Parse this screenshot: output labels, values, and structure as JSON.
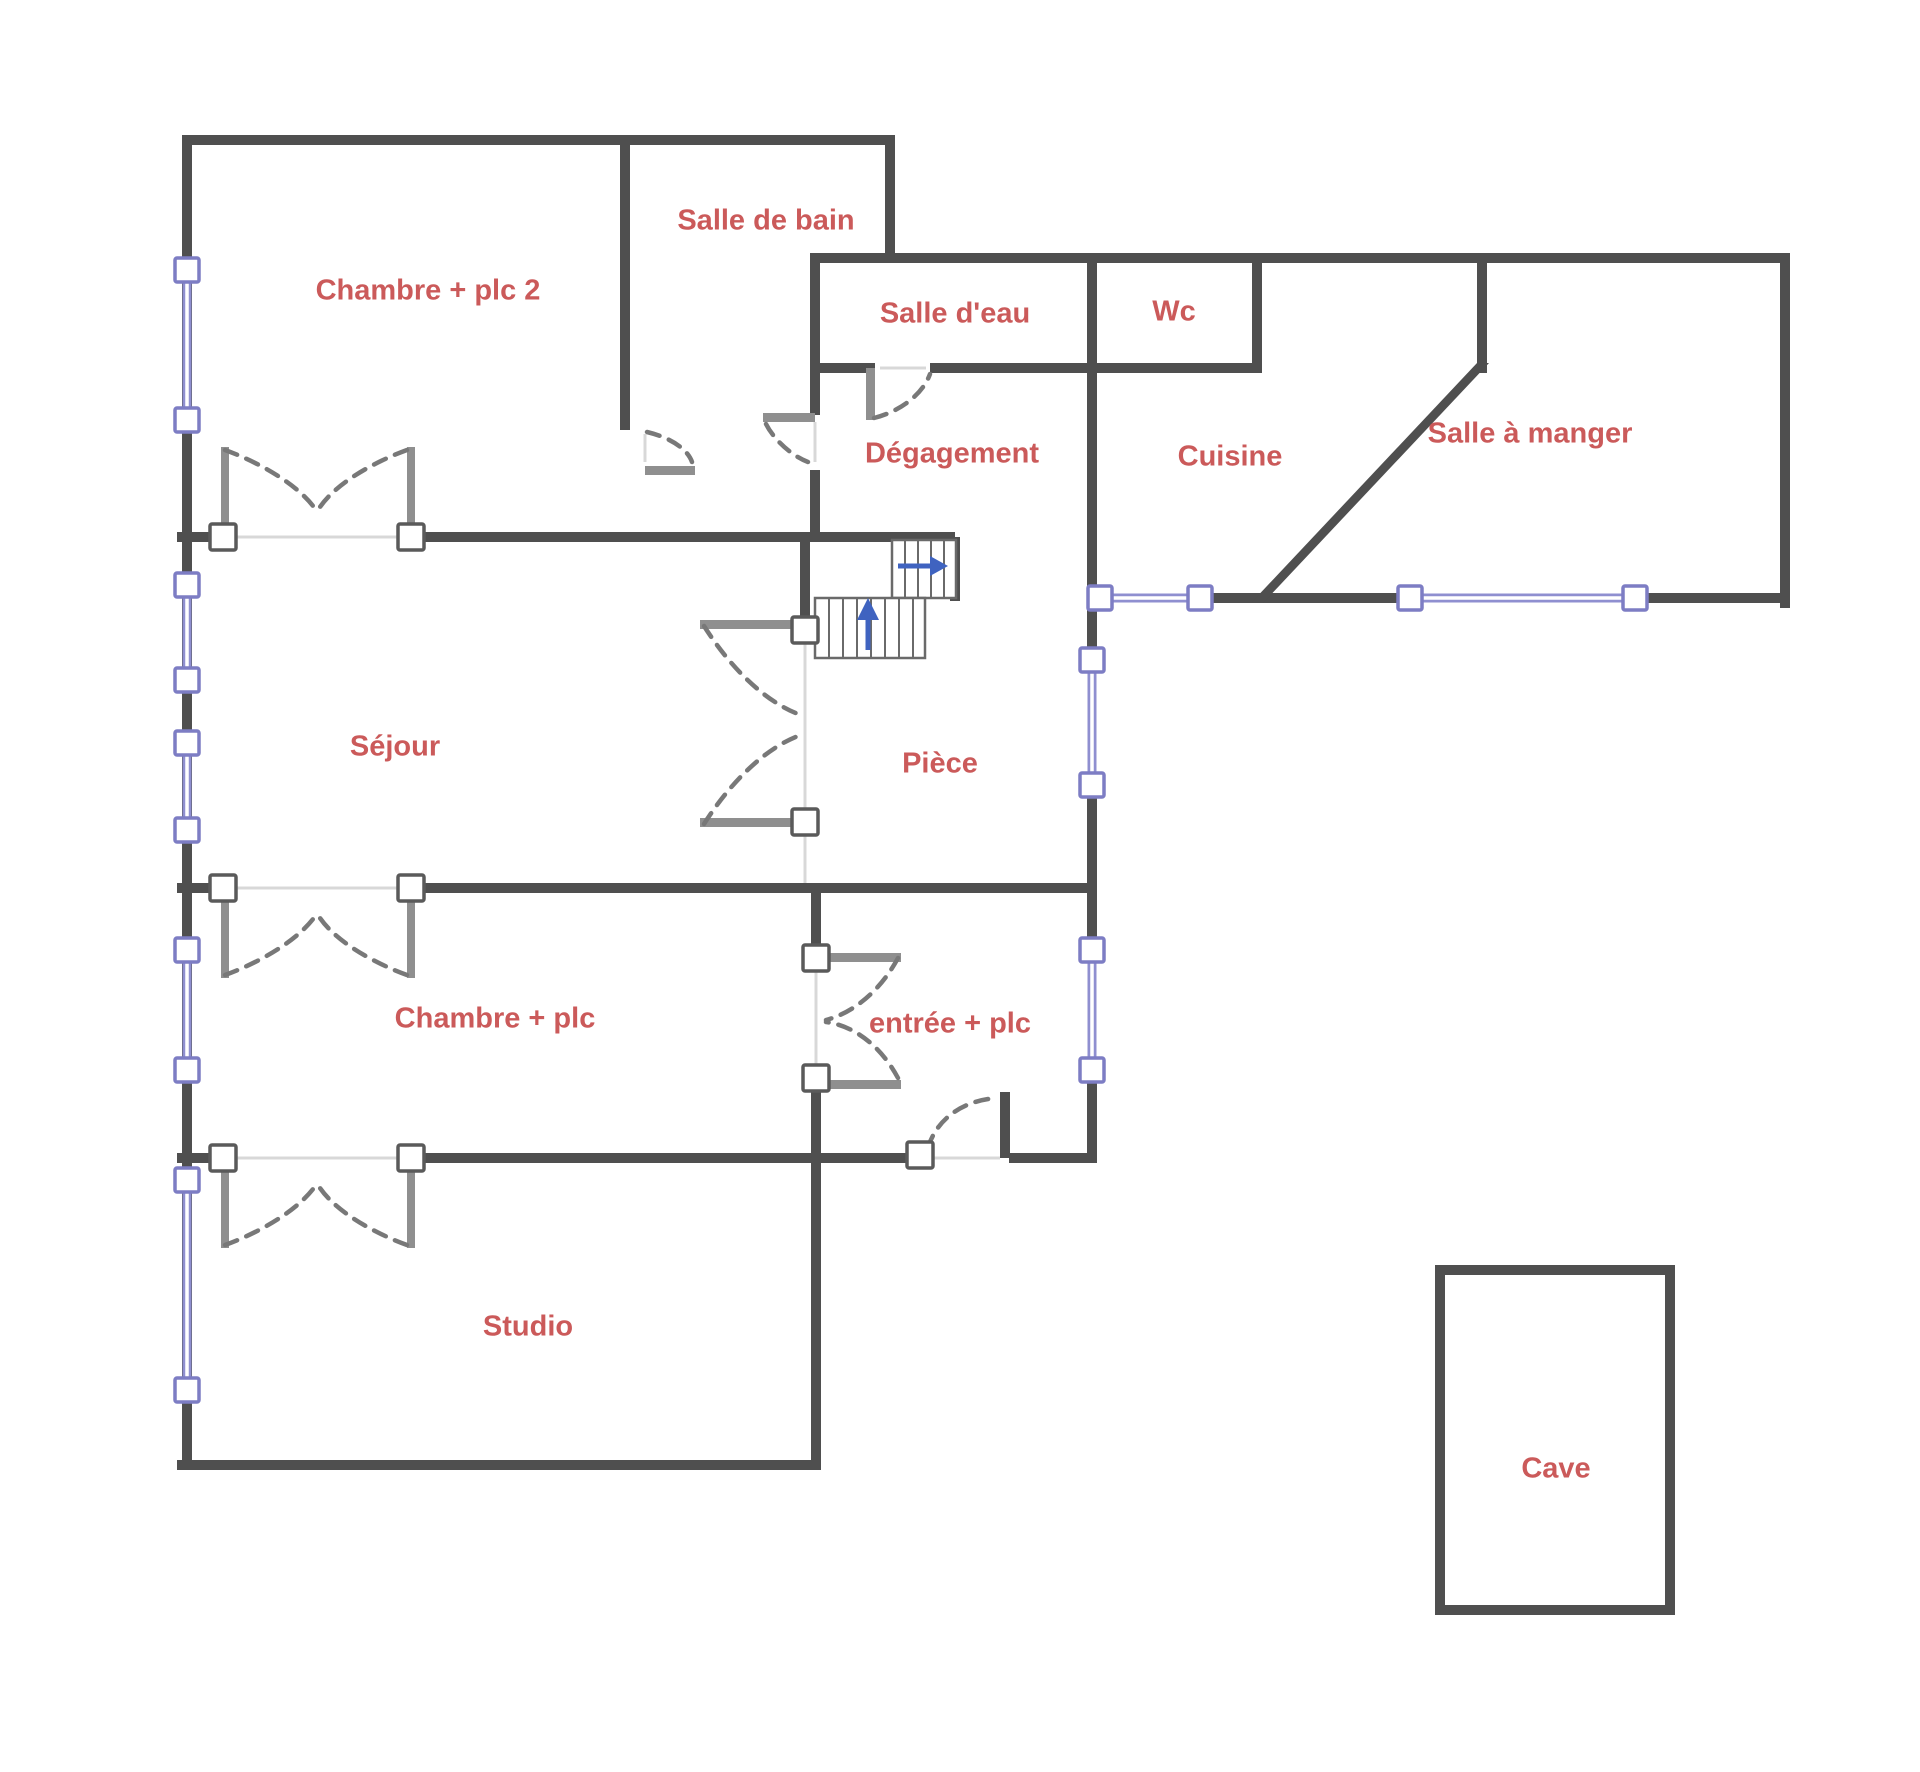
{
  "meta": {
    "canvas_width": 1920,
    "canvas_height": 1772,
    "type": "floor-plan"
  },
  "colors": {
    "background": "#ffffff",
    "wall": "#4f4f4f",
    "door_post": "#8f8f8f",
    "door_arc": "#787878",
    "thin_line": "#d8d8d8",
    "label": "#cb5a5a",
    "window_glass": "#8f8fd0",
    "window_border": "#7d7dc4",
    "handle_border": "#5a5a5a",
    "handle_fill": "#ffffff",
    "stair_outline": "#6a6a6a",
    "stair_arrow": "#3f63c0"
  },
  "rooms": [
    {
      "id": "chambre-plc-2",
      "label": "Chambre + plc 2",
      "x": 428,
      "y": 292
    },
    {
      "id": "salle-de-bain",
      "label": "Salle de bain",
      "x": 766,
      "y": 222
    },
    {
      "id": "salle-d-eau",
      "label": "Salle d'eau",
      "x": 955,
      "y": 315
    },
    {
      "id": "wc",
      "label": "Wc",
      "x": 1174,
      "y": 313
    },
    {
      "id": "degagement",
      "label": "Dégagement",
      "x": 952,
      "y": 455
    },
    {
      "id": "cuisine",
      "label": "Cuisine",
      "x": 1230,
      "y": 458
    },
    {
      "id": "salle-a-manger",
      "label": "Salle à manger",
      "x": 1530,
      "y": 435
    },
    {
      "id": "sejour",
      "label": "Séjour",
      "x": 395,
      "y": 748
    },
    {
      "id": "piece",
      "label": "Pièce",
      "x": 940,
      "y": 765
    },
    {
      "id": "chambre-plc",
      "label": "Chambre + plc",
      "x": 495,
      "y": 1020
    },
    {
      "id": "entree-plc",
      "label": "entrée + plc",
      "x": 950,
      "y": 1025
    },
    {
      "id": "studio",
      "label": "Studio",
      "x": 528,
      "y": 1328
    },
    {
      "id": "cave",
      "label": "Cave",
      "x": 1556,
      "y": 1470
    }
  ],
  "walls": {
    "rects": [
      [
        182,
        135,
        10,
        1335
      ],
      [
        182,
        135,
        713,
        10
      ],
      [
        885,
        135,
        10,
        128
      ],
      [
        810,
        253,
        980,
        10
      ],
      [
        1780,
        253,
        10,
        355
      ],
      [
        810,
        253,
        10,
        162
      ],
      [
        810,
        470,
        10,
        72
      ],
      [
        620,
        135,
        10,
        295
      ],
      [
        1087,
        253,
        10,
        407
      ],
      [
        1087,
        785,
        10,
        165
      ],
      [
        1087,
        1070,
        10,
        93
      ],
      [
        1252,
        253,
        10,
        120
      ],
      [
        1087,
        363,
        175,
        10
      ],
      [
        810,
        363,
        65,
        10
      ],
      [
        930,
        363,
        162,
        10
      ],
      [
        1477,
        253,
        10,
        120
      ],
      [
        177,
        532,
        48,
        10
      ],
      [
        415,
        532,
        540,
        10
      ],
      [
        950,
        537,
        10,
        64
      ],
      [
        800,
        532,
        10,
        93
      ],
      [
        1087,
        593,
        18,
        10
      ],
      [
        1195,
        593,
        220,
        10
      ],
      [
        1630,
        593,
        160,
        10
      ],
      [
        177,
        883,
        48,
        10
      ],
      [
        415,
        883,
        677,
        10
      ],
      [
        811,
        883,
        10,
        75
      ],
      [
        811,
        1080,
        10,
        78
      ],
      [
        177,
        1153,
        48,
        10
      ],
      [
        415,
        1153,
        510,
        10
      ],
      [
        1009,
        1153,
        83,
        10
      ],
      [
        1000,
        1092,
        10,
        66
      ],
      [
        811,
        1153,
        10,
        317
      ],
      [
        177,
        1460,
        644,
        10
      ],
      [
        1435,
        1265,
        240,
        10
      ],
      [
        1435,
        1265,
        10,
        350
      ],
      [
        1665,
        1265,
        10,
        350
      ],
      [
        1435,
        1605,
        240,
        10
      ]
    ],
    "polygons": [
      [
        [
          1477,
          363
        ],
        [
          1489,
          363
        ],
        [
          1263,
          603
        ],
        [
          1251,
          603
        ]
      ]
    ]
  },
  "door_posts": [
    [
      221,
      447,
      8,
      88
    ],
    [
      407,
      447,
      8,
      88
    ],
    [
      221,
      893,
      8,
      85
    ],
    [
      407,
      893,
      8,
      85
    ],
    [
      221,
      1163,
      8,
      85
    ],
    [
      407,
      1163,
      8,
      85
    ],
    [
      700,
      620,
      105,
      9
    ],
    [
      700,
      818,
      105,
      9
    ],
    [
      816,
      953,
      85,
      9
    ],
    [
      816,
      1080,
      85,
      9
    ],
    [
      645,
      466,
      50,
      9
    ],
    [
      763,
      413,
      52,
      9
    ],
    [
      866,
      368,
      9,
      52
    ]
  ],
  "door_handles": [
    [
      223,
      537
    ],
    [
      411,
      537
    ],
    [
      223,
      888
    ],
    [
      411,
      888
    ],
    [
      223,
      1158
    ],
    [
      411,
      1158
    ],
    [
      805,
      630
    ],
    [
      805,
      822
    ],
    [
      816,
      958
    ],
    [
      816,
      1078
    ],
    [
      920,
      1155
    ]
  ],
  "door_arcs": [
    "M 225,450 C 258,462 298,484 316,510",
    "M 407,450 C 374,462 334,484 318,510",
    "M 225,975 C 258,963 298,941 316,915",
    "M 407,975 C 374,963 334,941 318,915",
    "M 225,1245 C 258,1233 298,1211 316,1185",
    "M 407,1245 C 374,1233 334,1211 318,1185",
    "M 704,626 C 728,664 762,700 798,714",
    "M 704,824 C 728,786 762,750 798,736",
    "M 898,958 C 882,988 856,1012 826,1020",
    "M 898,1078 C 882,1048 856,1026 826,1022",
    "M 647,432 C 672,438 688,450 692,462",
    "M 766,424 C 774,440 792,456 808,462",
    "M 874,418 C 898,412 922,396 930,374",
    "M 928,1148 C 936,1120 962,1100 998,1098"
  ],
  "thin_lines": [
    [
      231,
      537,
      403,
      537
    ],
    [
      231,
      888,
      403,
      888
    ],
    [
      231,
      1158,
      403,
      1158
    ],
    [
      805,
      642,
      805,
      810
    ],
    [
      805,
      834,
      805,
      883
    ],
    [
      816,
      970,
      816,
      1068
    ],
    [
      930,
      1158,
      1000,
      1158
    ],
    [
      880,
      368,
      926,
      368
    ],
    [
      645,
      434,
      645,
      462
    ],
    [
      815,
      422,
      815,
      462
    ]
  ],
  "windows": {
    "vertical": [
      {
        "x": 187,
        "y1": 270,
        "y2": 420
      },
      {
        "x": 187,
        "y1": 585,
        "y2": 680
      },
      {
        "x": 187,
        "y1": 743,
        "y2": 830
      },
      {
        "x": 187,
        "y1": 950,
        "y2": 1070
      },
      {
        "x": 187,
        "y1": 1180,
        "y2": 1390
      },
      {
        "x": 1092,
        "y1": 660,
        "y2": 785
      },
      {
        "x": 1092,
        "y1": 950,
        "y2": 1070
      }
    ],
    "horizontal": [
      {
        "y": 598,
        "x1": 1100,
        "x2": 1200
      },
      {
        "y": 598,
        "x1": 1410,
        "x2": 1635
      }
    ]
  },
  "stairs": {
    "runs": [
      {
        "x": 892,
        "y": 540,
        "w": 64,
        "h": 58,
        "treads_x": [
          905,
          918,
          931,
          944
        ]
      },
      {
        "x": 815,
        "y": 598,
        "w": 110,
        "h": 60,
        "treads_x": [
          829,
          843,
          857,
          871,
          885,
          899,
          913
        ]
      }
    ],
    "arrow_right": {
      "stem": [
        898,
        566,
        930,
        566
      ],
      "head": [
        [
          930,
          556
        ],
        [
          948,
          566
        ],
        [
          930,
          576
        ]
      ]
    },
    "arrow_up": {
      "stem": [
        868,
        650,
        868,
        618
      ],
      "head": [
        [
          857,
          620
        ],
        [
          879,
          620
        ],
        [
          868,
          598
        ]
      ]
    }
  }
}
